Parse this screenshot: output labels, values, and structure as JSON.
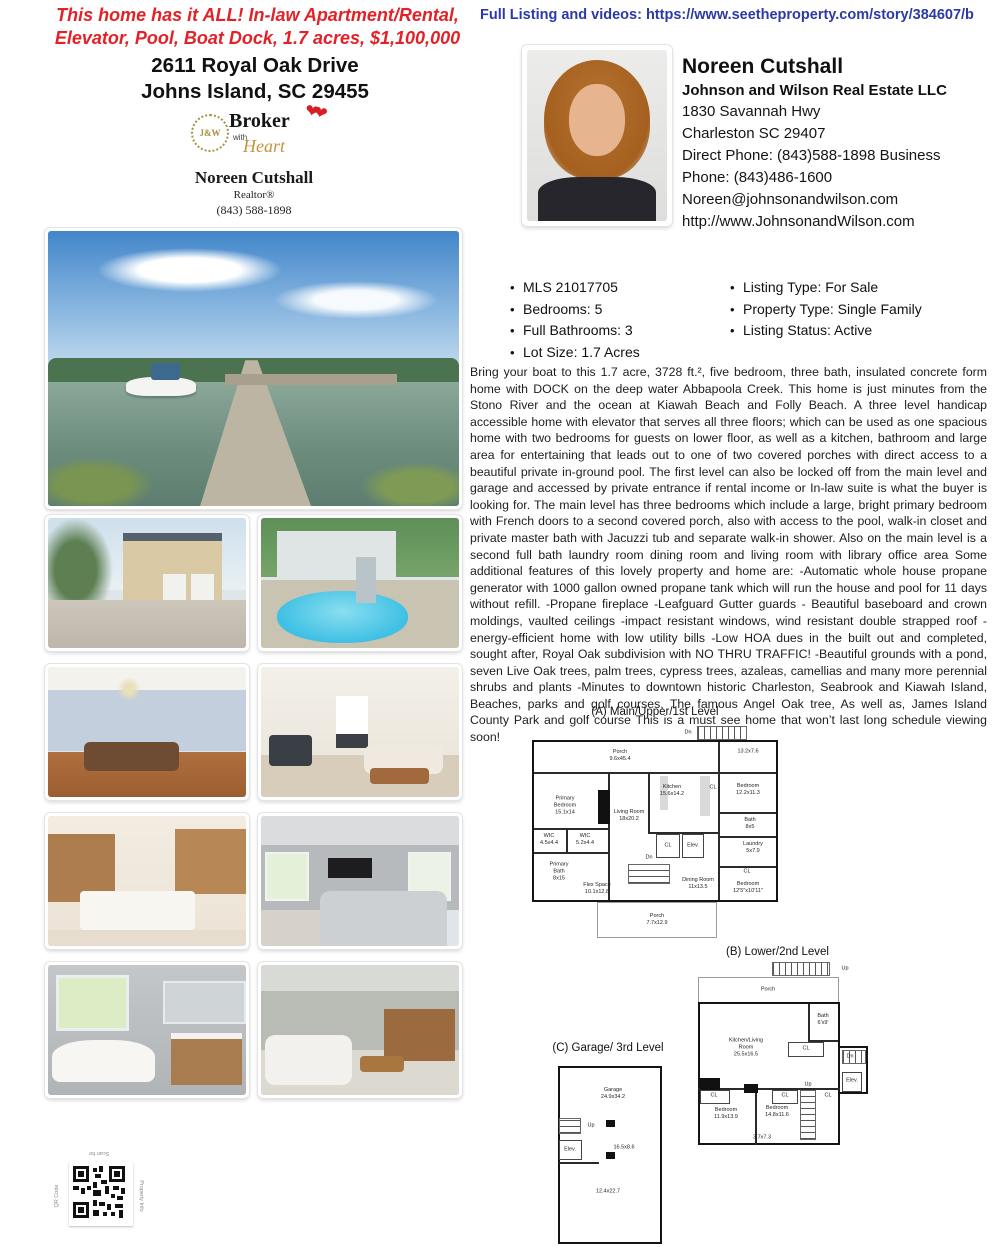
{
  "header": {
    "tagline_line1": "This home has it ALL!  In-law Apartment/Rental,",
    "tagline_line2": "Elevator, Pool, Boat Dock, 1.7 acres, $1,100,000",
    "listing_link": "Full Listing and videos: https://www.seetheproperty.com/story/384607/b"
  },
  "property": {
    "address_line1": "2611 Royal Oak Drive",
    "address_line2": "Johns Island, SC 29455"
  },
  "logo": {
    "monogram": "J&W",
    "title": "Broker",
    "with_word": "with",
    "script_word": "Heart",
    "hearts": "❤❤",
    "agent": "Noreen Cutshall",
    "role": "Realtor®",
    "phone": "(843) 588-1898"
  },
  "agent": {
    "name": "Noreen Cutshall",
    "company": "Johnson and Wilson Real Estate LLC",
    "address1": "1830 Savannah Hwy",
    "address2": "Charleston SC 29407",
    "phone1": "Direct Phone: (843)588-1898 Business",
    "phone2": "Phone: (843)486-1600",
    "email": "Noreen@johnsonandwilson.com",
    "website": "http://www.JohnsonandWilson.com"
  },
  "details": {
    "left": [
      "MLS 21017705",
      "Bedrooms: 5",
      "Full Bathrooms: 3",
      "Lot Size: 1.7 Acres"
    ],
    "right": [
      "Listing Type: For Sale",
      "Property Type: Single Family",
      "Listing Status: Active"
    ]
  },
  "description": "Bring your boat to this 1.7 acre, 3728 ft.², five bedroom, three bath, insulated concrete form home with DOCK on the deep water Abbapoola Creek. This home is just minutes from the Stono River and the ocean at Kiawah Beach and Folly Beach. A three level handicap accessible home with elevator that serves all three floors; which can be used as one spacious home with two bedrooms for guests on lower floor, as well as a kitchen, bathroom and large area for entertaining that leads out to one of two covered porches with direct access to a beautiful private in-ground pool. The first level can also be locked off from the main level and garage and accessed by private entrance if rental income or In-law suite is what the buyer is looking for. The main level has three bedrooms which include a large, bright primary bedroom with French doors to a second covered porch, also with access to the pool, walk-in closet and private master bath with Jacuzzi tub and separate walk-in shower. Also on the main level is a second full bath laundry room dining room and living room with library office area Some additional features of this lovely property and home are: -Automatic whole house propane generator with 1000 gallon owned propane tank which will run the house and pool for 11 days without refill. -Propane fireplace -Leafguard Gutter guards - Beautiful baseboard and crown moldings, vaulted ceilings -impact resistant windows, wind resistant double strapped roof -energy-efficient home with low utility bills -Low HOA dues in the built out and completed, sought after, Royal Oak subdivision with NO THRU TRAFFIC! -Beautiful grounds with a pond, seven Live Oak trees, palm trees, cypress trees, azaleas, camellias and many more perennial shrubs and plants -Minutes to downtown historic Charleston, Seabrook and Kiawah Island, Beaches, parks and golf courses, The famous Angel Oak tree, As well as, James Island County Park and golf course This is a must see home that won’t last long schedule viewing soon!",
  "floorplans": {
    "a": {
      "title": "(A) Main/Upper/1st Level",
      "rooms": [
        "Dn",
        "Porch\n9.6x45.4",
        "13.2x7.6",
        "Primary\nBedroom\n15.1x14",
        "Living Room\n18x20.2",
        "Kitchen\n15.6x14.2",
        "CL",
        "Bedroom\n12.2x11.3",
        "WIC\n4.5x4.4",
        "WIC\n5.2x4.4",
        "Primary\nBath\n8x15",
        "CL",
        "Elev.",
        "Bath\n8x5",
        "Laundry\n5x7.9",
        "CL",
        "Dn",
        "Flex Space\n10.1x12.8",
        "Dining Room\n11x13.5",
        "Bedroom\n12'5\"x10'11\"",
        "Porch\n7.7x12.9"
      ]
    },
    "b": {
      "title": "(B) Lower/2nd Level",
      "rooms": [
        "Up",
        "Porch",
        "Kitchen/Living\nRoom\n25.5x16.5",
        "Bath\n6'x9'",
        "CL",
        "Dn",
        "Elev.",
        "CL",
        "CL",
        "Up",
        "CL",
        "Bedroom\n11.9x13.9",
        "Bedroom\n14.8x11.6",
        "3.7x7.3"
      ]
    },
    "c": {
      "title": "(C) Garage/ 3rd Level",
      "rooms": [
        "Garage\n24.9x34.2",
        "Up",
        "Elev.",
        "16.5x8.6",
        "12.4x22.7"
      ]
    }
  },
  "qr": {
    "top": "Scan for",
    "left": "QR Code",
    "right": "Property Info"
  }
}
